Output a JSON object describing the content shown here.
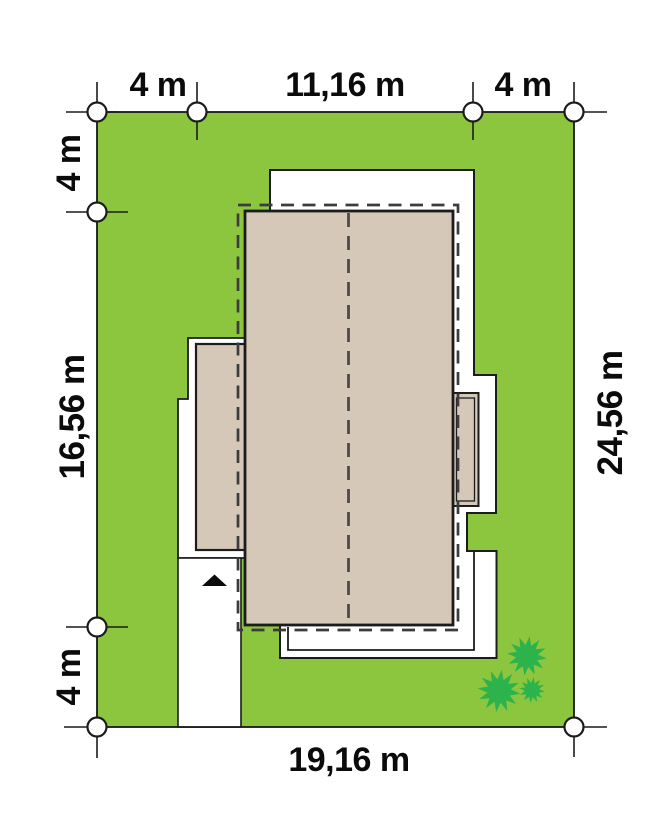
{
  "plot_plan": {
    "dimension_labels": {
      "top_left_setback": "4 m",
      "top_building_width": "11,16 m",
      "top_right_setback": "4 m",
      "left_top_setback": "4 m",
      "left_building_depth": "16,56 m",
      "left_bottom_setback": "4 m",
      "right_plot_depth": "24,56 m",
      "bottom_plot_width": "19,16 m"
    },
    "colors": {
      "lawn_green": "#8CC63F",
      "roof_beige": "#D5C8B8",
      "bush_green": "#2CB34C",
      "line_black": "#1C1C1C",
      "dash_gray": "#3C3C3C"
    },
    "icons": {
      "boundary_marker": "white-circle-outline",
      "bush": "spiky-star-shrub",
      "entrance_arrow": "black-triangle-up"
    }
  }
}
